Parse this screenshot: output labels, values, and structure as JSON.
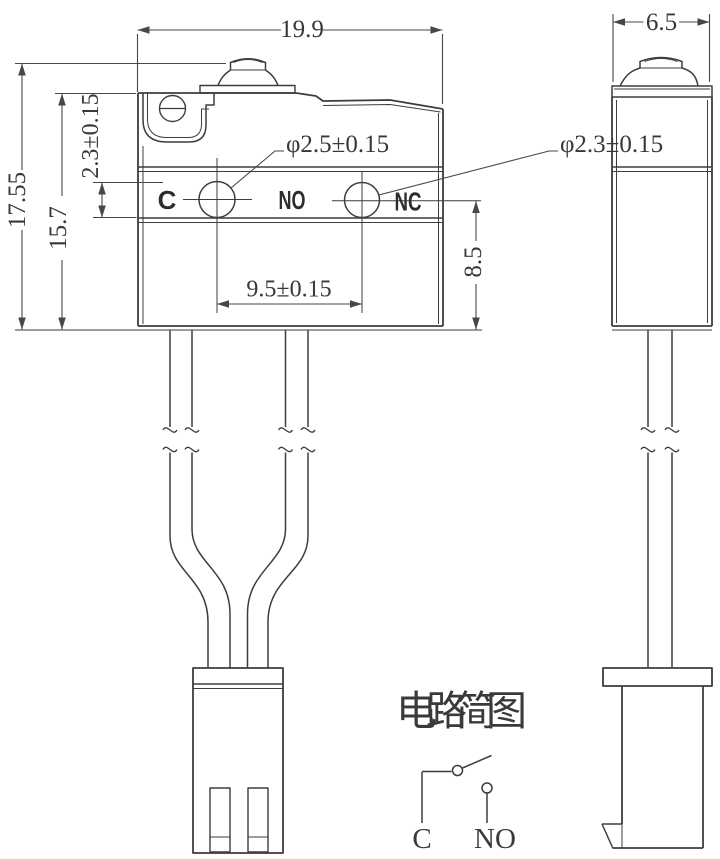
{
  "page": {
    "background": "#ffffff",
    "line_color": "#3d3d3d",
    "dim_color": "#474747"
  },
  "front_view": {
    "dim_width": "19.9",
    "dim_total_height": "17.55",
    "dim_body_height": "15.7",
    "dim_hole_offset": "2.3±0.15",
    "hole_left_diameter": "φ2.5±0.15",
    "hole_right_diameter": "φ2.3±0.15",
    "dim_hole_spacing": "9.5±0.15",
    "dim_center_to_bottom": "8.5",
    "terminal_labels": {
      "common": "C",
      "normally_open": "NO",
      "normally_closed": "NC"
    }
  },
  "side_view": {
    "dim_width": "6.5"
  },
  "circuit_diagram": {
    "title": "电路简图",
    "terminal_c": "C",
    "terminal_no": "NO"
  }
}
